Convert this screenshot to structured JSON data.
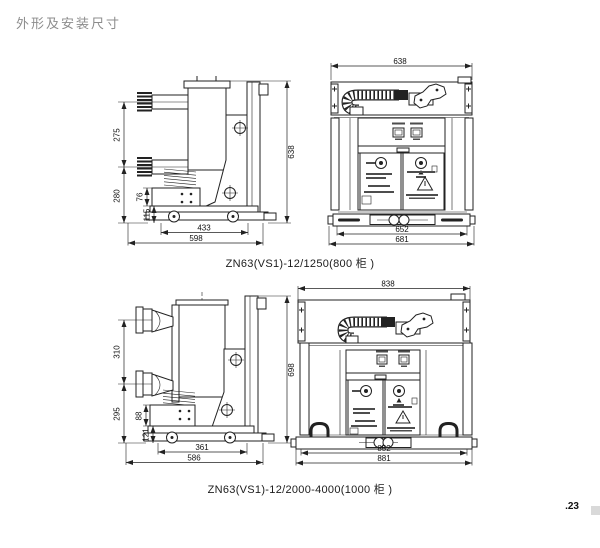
{
  "page": {
    "title": "外形及安装尺寸",
    "page_number": ".23",
    "colors": {
      "line": "#222222",
      "title_gray": "#8c8c8c",
      "paper": "#ffffff",
      "corner_mark": "#d9d9d9"
    }
  },
  "figures": [
    {
      "caption": "ZN63(VS1)-12/1250(800 柜 )",
      "side_dims": {
        "pole_pitch": "275",
        "lower_span": "280",
        "interlock_height": "76",
        "chassis_height": "115",
        "wheel_base": "433",
        "depth": "598",
        "height": "638"
      },
      "front_dims": {
        "top_width": "638",
        "base_width": "652",
        "overall_width": "681"
      }
    },
    {
      "caption": "ZN63(VS1)-12/2000-4000(1000 柜 )",
      "side_dims": {
        "pole_pitch": "310",
        "lower_span": "295",
        "interlock_height": "88",
        "chassis_height": "121",
        "wheel_base": "361",
        "depth": "586",
        "height": "698"
      },
      "front_dims": {
        "top_width": "838",
        "base_width": "852",
        "overall_width": "881"
      }
    }
  ]
}
